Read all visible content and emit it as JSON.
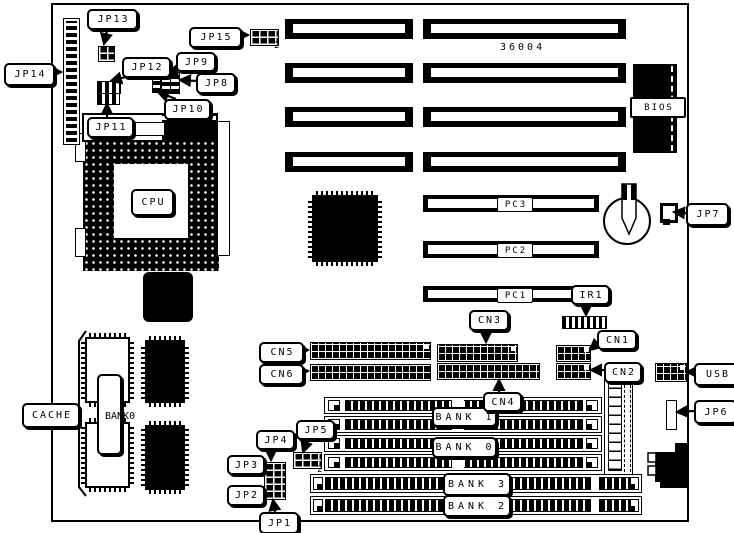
{
  "board": {
    "part_number": "36004"
  },
  "labels": {
    "jp1": "JP1",
    "jp2": "JP2",
    "jp3": "JP3",
    "jp4": "JP4",
    "jp5": "JP5",
    "jp6": "JP6",
    "jp7": "JP7",
    "jp8": "JP8",
    "jp9": "JP9",
    "jp10": "JP10",
    "jp11": "JP11",
    "jp12": "JP12",
    "jp13": "JP13",
    "jp14": "JP14",
    "jp15": "JP15",
    "cn1": "CN1",
    "cn2": "CN2",
    "cn3": "CN3",
    "cn4": "CN4",
    "cn5": "CN5",
    "cn6": "CN6",
    "pc1": "PC1",
    "pc2": "PC2",
    "pc3": "PC3",
    "ir1": "IR1",
    "usb": "USB",
    "bios": "BIOS",
    "cpu": "CPU",
    "cache": "CACHE",
    "bank0": "BANK 0",
    "bank1": "BANK 1",
    "bank2": "BANK 2",
    "bank3": "BANK 3",
    "cache_bank": "BANK0",
    "jp15_pin2": "2",
    "jp5_pin2": "2"
  }
}
